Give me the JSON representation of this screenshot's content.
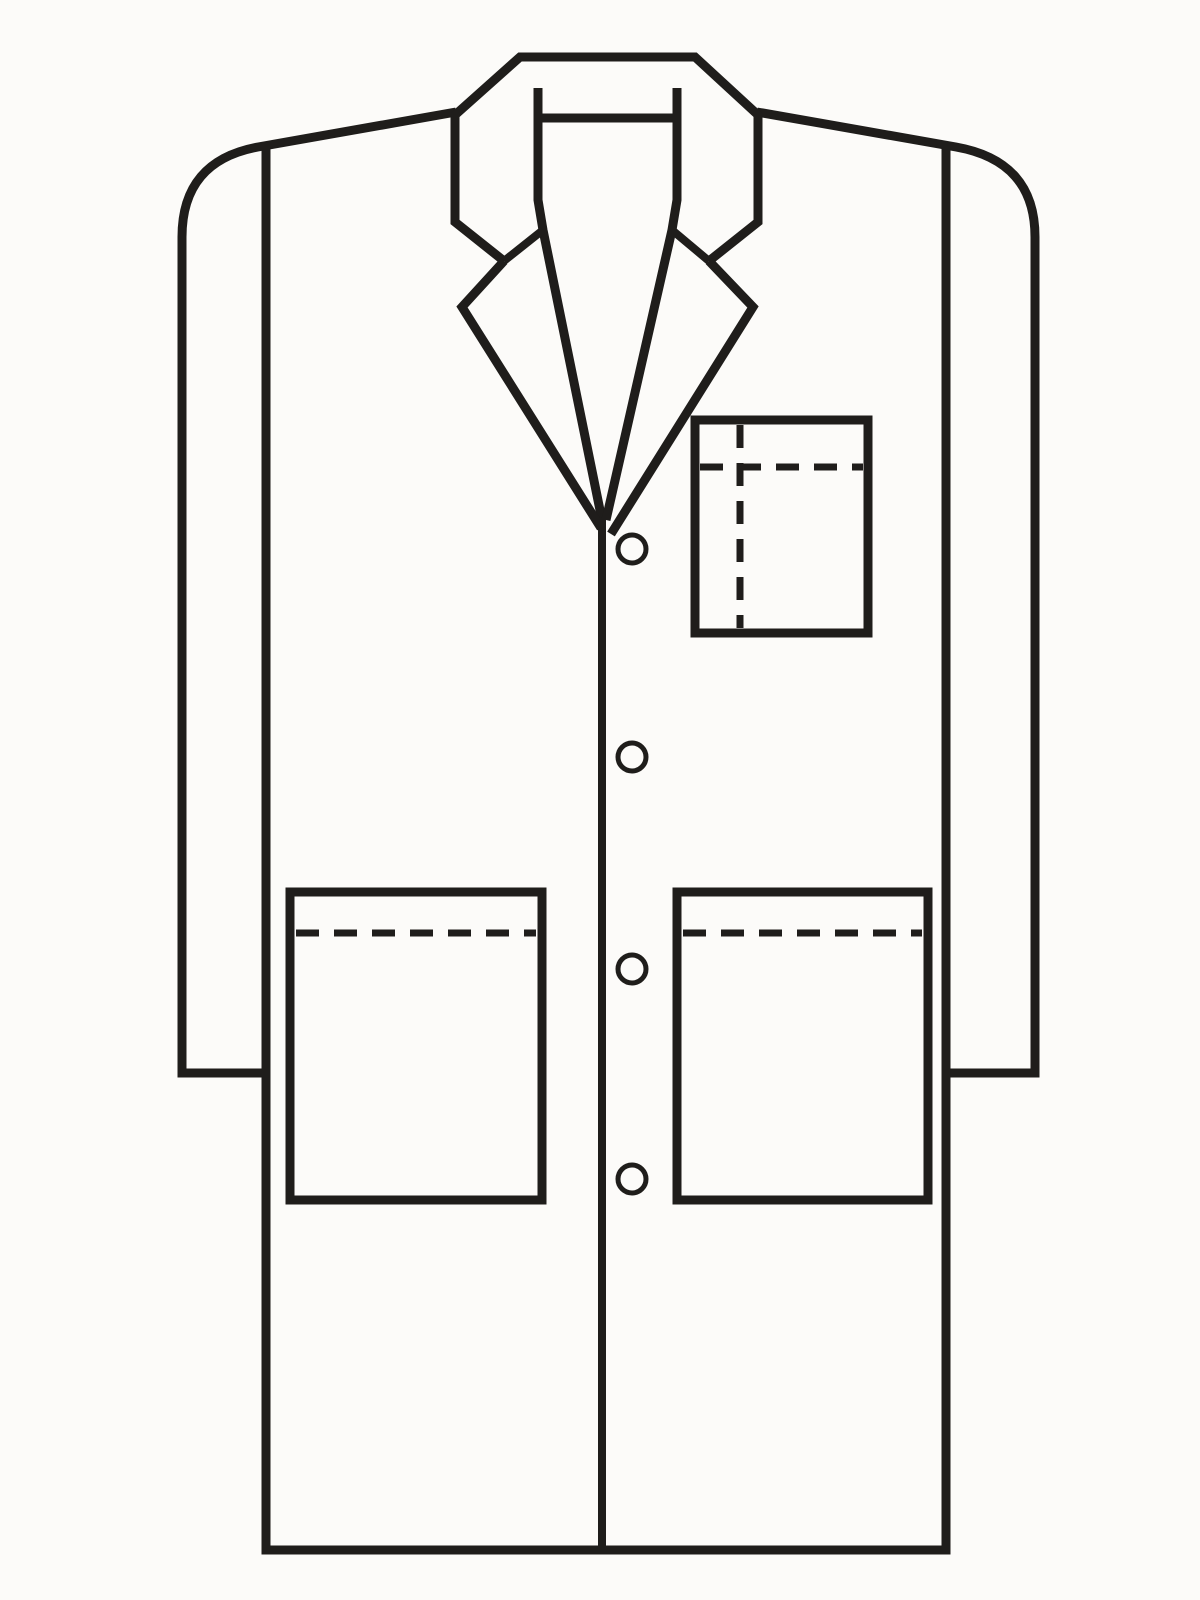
{
  "page": {
    "title": "Lab coat technical line drawing",
    "background": "#fcfbf9",
    "ink": "#1f1d1b"
  },
  "illustration": {
    "garment": "lab-coat-front-view",
    "viewBox": "0 0 1200 1600",
    "dash_pattern": "23 15",
    "buttons_count": 4,
    "pockets": [
      "chest-pocket-with-pen-divider",
      "hip-pocket-left",
      "hip-pocket-right"
    ],
    "shapes": [
      {
        "name": "left-shoulder-and-sleeve-outline",
        "type": "path",
        "d": "M 456,112 L 258,147 Q 182,161 182,237 L 182,1073 L 266,1073",
        "w": 9
      },
      {
        "name": "right-shoulder-and-sleeve-outline",
        "type": "path",
        "d": "M 757,112 L 956,147 Q 1035,161 1035,237 L 1035,1073 L 946,1073",
        "w": 9
      },
      {
        "name": "body-sides-and-hem-outline",
        "type": "path",
        "d": "M 266,146 L 266,1550 L 946,1550 L 946,146",
        "w": 9
      },
      {
        "name": "collar-outer-edge",
        "type": "path",
        "d": "M 504,261 L 455,222 L 455,115 L 520,57 L 695,57 L 758,115 L 758,222 L 709,261",
        "w": 9
      },
      {
        "name": "hanger-loop-bar",
        "type": "path",
        "d": "M 538,118 L 677,118",
        "w": 9
      },
      {
        "name": "neckline-left",
        "type": "path",
        "d": "M 538,88 L 538,200 L 543,230 L 602,520",
        "w": 9
      },
      {
        "name": "neckline-right",
        "type": "path",
        "d": "M 677,88 L 677,200 L 672,230 L 606,520",
        "w": 9
      },
      {
        "name": "gorge-seam-left",
        "type": "path",
        "d": "M 543,230 L 504,261",
        "w": 8
      },
      {
        "name": "gorge-seam-right",
        "type": "path",
        "d": "M 672,230 L 709,261",
        "w": 8
      },
      {
        "name": "lapel-left-edge",
        "type": "path",
        "d": "M 504,261 L 462,307 L 601,528",
        "w": 9
      },
      {
        "name": "lapel-right-edge",
        "type": "path",
        "d": "M 709,261 L 753,307 L 611,534",
        "w": 9
      },
      {
        "name": "front-placket-line",
        "type": "path",
        "d": "M 602,518 L 602,1550",
        "w": 8
      },
      {
        "name": "chest-pocket",
        "type": "rect",
        "x": 695,
        "y": 420,
        "width": 173,
        "height": 213,
        "w": 9
      },
      {
        "name": "chest-pocket-stitch-line",
        "type": "path",
        "d": "M 700,467 L 863,467",
        "w": 7,
        "dashed": true
      },
      {
        "name": "chest-pocket-pen-divider-stitch",
        "type": "path",
        "d": "M 740,425 L 740,628",
        "w": 7,
        "dashed": true
      },
      {
        "name": "hip-pocket-left",
        "type": "rect",
        "x": 290,
        "y": 892,
        "width": 252,
        "height": 308,
        "w": 9
      },
      {
        "name": "hip-pocket-left-stitch-line",
        "type": "path",
        "d": "M 296,933 L 536,933",
        "w": 7,
        "dashed": true
      },
      {
        "name": "hip-pocket-right",
        "type": "rect",
        "x": 677,
        "y": 892,
        "width": 251,
        "height": 308,
        "w": 9
      },
      {
        "name": "hip-pocket-right-stitch-line",
        "type": "path",
        "d": "M 683,933 L 922,933",
        "w": 7,
        "dashed": true
      }
    ],
    "buttons": {
      "cx": 632,
      "cys": [
        549,
        757,
        969,
        1179
      ],
      "r": 14,
      "stroke_width": 5
    }
  }
}
